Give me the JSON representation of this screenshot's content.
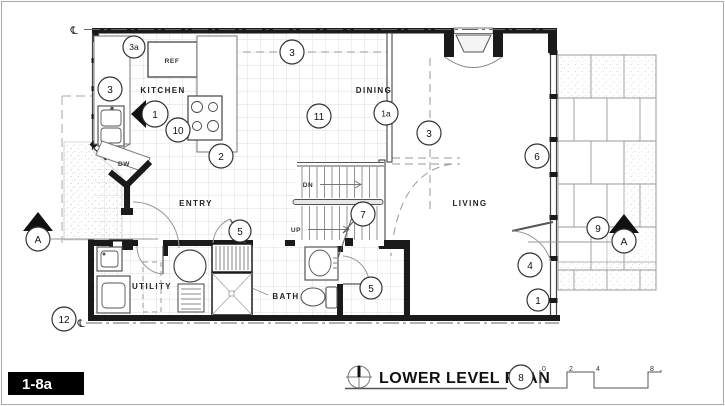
{
  "sheet_label": "1-8a",
  "title_block": {
    "title": "LOWER LEVEL PLAN",
    "callout": "8",
    "scale_marks": [
      "0",
      "2",
      "4",
      "8"
    ]
  },
  "rooms": {
    "kitchen": "KITCHEN",
    "dining": "DINING",
    "entry": "ENTRY",
    "living": "LIVING",
    "utility": "UTILITY",
    "bath": "BATH"
  },
  "fixtures": {
    "ref": "REF",
    "dw": "DW"
  },
  "stairs": {
    "down": "DN",
    "up": "UP"
  },
  "callouts": {
    "k3a": "3a",
    "k3_left": "3",
    "k3_top": "3",
    "k3_living": "3",
    "k1": "1",
    "k10": "10",
    "k2": "2",
    "k11": "11",
    "k1a": "1a",
    "k6": "6",
    "k9": "9",
    "k4": "4",
    "k1_br": "1",
    "k5_entry": "5",
    "k5_bath": "5",
    "k7": "7",
    "k12": "12"
  },
  "section_markers": {
    "left": "A",
    "right": "A"
  },
  "symbols": {
    "centerline": "℄"
  },
  "colors": {
    "wall": "#1a1a1a",
    "line": "#555555",
    "tile_grid": "#dddddd",
    "paver": "#999999",
    "dashed": "#999999"
  }
}
